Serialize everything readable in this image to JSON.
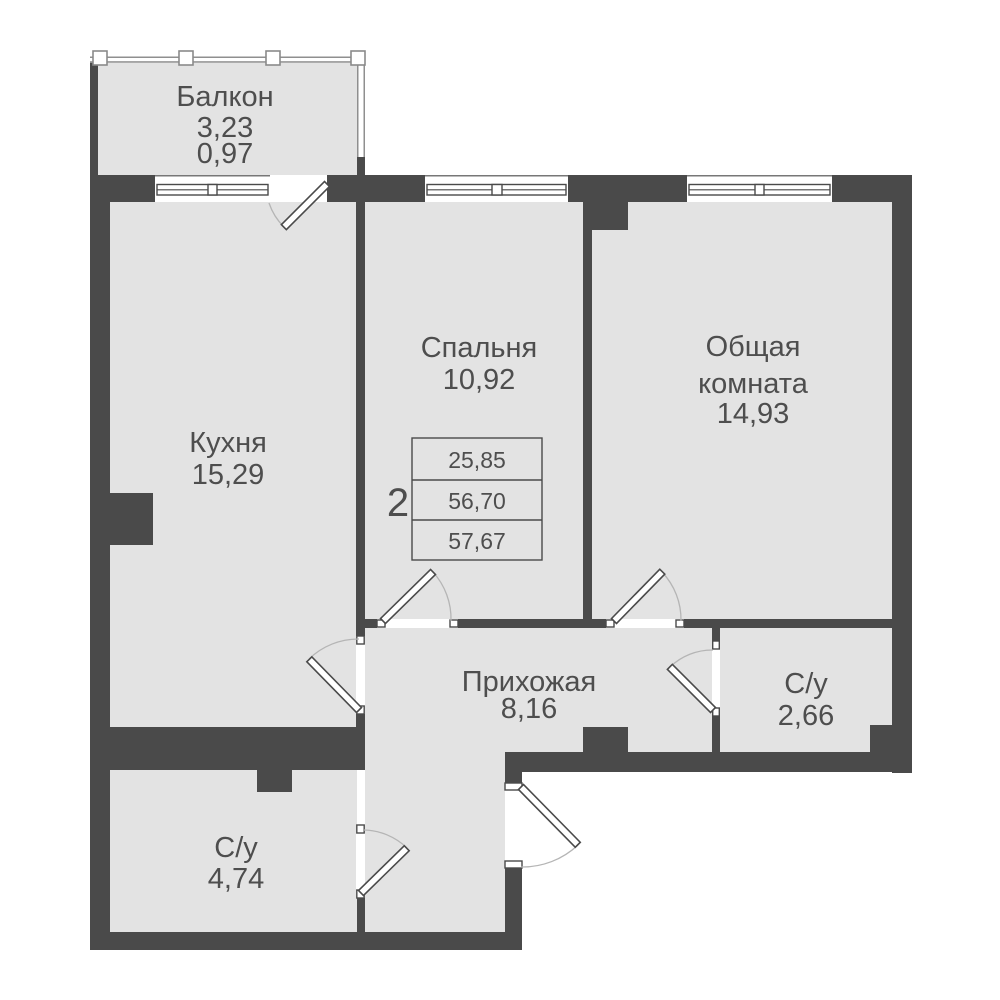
{
  "plan": {
    "title": "2-room apartment floor plan",
    "colors": {
      "background": "#ffffff",
      "wall": "#4a4a4a",
      "floor": "#e3e3e3",
      "text": "#4e4e4e",
      "door_arc": "#b5b5b5",
      "railing": "#8f8f8f"
    },
    "rooms": {
      "balcony": {
        "name": "Балкон",
        "area": "3,23",
        "area_reduced": "0,97"
      },
      "kitchen": {
        "name": "Кухня",
        "area": "15,29"
      },
      "bedroom": {
        "name": "Спальня",
        "area": "10,92"
      },
      "living_room": {
        "name_line1": "Общая",
        "name_line2": "комната",
        "area": "14,93"
      },
      "hallway": {
        "name": "Прихожая",
        "area": "8,16"
      },
      "bathroom_small": {
        "name": "С/у",
        "area": "2,66"
      },
      "bathroom_large": {
        "name": "С/у",
        "area": "4,74"
      }
    },
    "info_table": {
      "rooms_count": "2",
      "rows": [
        "25,85",
        "56,70",
        "57,67"
      ]
    }
  }
}
